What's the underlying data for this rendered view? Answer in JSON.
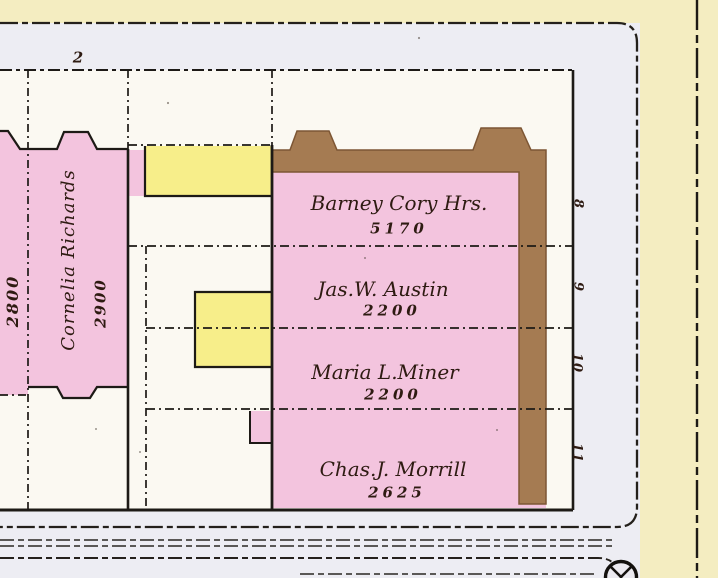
{
  "map": {
    "block_label": "2",
    "left_parcels": {
      "parcel_2800_value": "2800",
      "cornelia_owner": "Cornelia Richards",
      "cornelia_value": "2900"
    },
    "main_parcels": [
      {
        "owner": "Barney Cory Hrs.",
        "value": "5170",
        "lot": "8"
      },
      {
        "owner": "Jas.W. Austin",
        "value": "2200",
        "lot": "9"
      },
      {
        "owner": "Maria L.Miner",
        "value": "2200",
        "lot": "10"
      },
      {
        "owner": "Chas.J. Morrill",
        "value": "2625",
        "lot": "11"
      }
    ],
    "icons": {
      "monument": "survey-monument-icon"
    },
    "colors": {
      "street_yellow": "#f4edc1",
      "sidewalk_lavender": "#ededf3",
      "block_white": "#fbf9f2",
      "parcel_pink": "#f3c4de",
      "building_yellow": "#f7ee8a",
      "building_brown": "#a57b52",
      "line_black": "#1d1a16",
      "ink_brown": "#2e1b12"
    }
  }
}
